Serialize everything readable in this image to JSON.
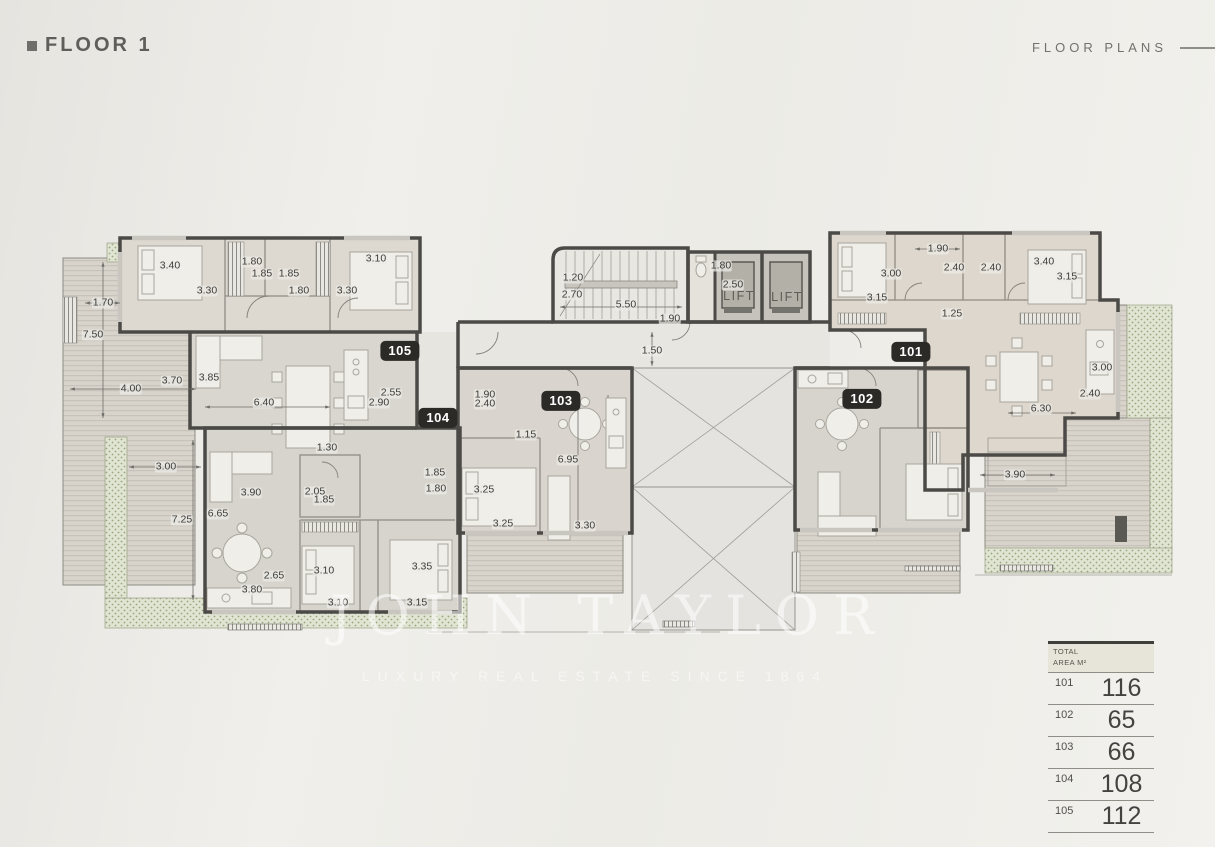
{
  "header": {
    "title": "FLOOR 1",
    "section": "FLOOR PLANS"
  },
  "watermark": {
    "brand": "JOHN TAYLOR",
    "tagline": "LUXURY REAL ESTATE SINCE 1864"
  },
  "plan": {
    "floor_name": "Floor 1",
    "lift_label": "LIFT",
    "lifts": [
      {
        "x": 739,
        "y": 296
      },
      {
        "x": 787,
        "y": 297
      }
    ],
    "badges": [
      {
        "unit": "105",
        "x": 400,
        "y": 351
      },
      {
        "unit": "104",
        "x": 438,
        "y": 418
      },
      {
        "unit": "103",
        "x": 561,
        "y": 401
      },
      {
        "unit": "102",
        "x": 862,
        "y": 399
      },
      {
        "unit": "101",
        "x": 911,
        "y": 352
      }
    ],
    "dimensions": [
      {
        "t": "3.40",
        "x": 170,
        "y": 266
      },
      {
        "t": "1.80",
        "x": 252,
        "y": 262
      },
      {
        "t": "1.85",
        "x": 262,
        "y": 274
      },
      {
        "t": "1.85",
        "x": 289,
        "y": 274
      },
      {
        "t": "3.10",
        "x": 376,
        "y": 259
      },
      {
        "t": "3.30",
        "x": 207,
        "y": 291
      },
      {
        "t": "1.80",
        "x": 299,
        "y": 291
      },
      {
        "t": "3.30",
        "x": 347,
        "y": 291
      },
      {
        "t": "1.70",
        "x": 103,
        "y": 303
      },
      {
        "t": "7.50",
        "x": 93,
        "y": 335
      },
      {
        "t": "3.70",
        "x": 172,
        "y": 381
      },
      {
        "t": "3.85",
        "x": 209,
        "y": 378
      },
      {
        "t": "4.00",
        "x": 131,
        "y": 389
      },
      {
        "t": "6.40",
        "x": 264,
        "y": 403
      },
      {
        "t": "2.55",
        "x": 391,
        "y": 393
      },
      {
        "t": "2.90",
        "x": 379,
        "y": 403
      },
      {
        "t": "1.30",
        "x": 327,
        "y": 448
      },
      {
        "t": "1.20",
        "x": 573,
        "y": 278
      },
      {
        "t": "2.70",
        "x": 572,
        "y": 295
      },
      {
        "t": "5.50",
        "x": 626,
        "y": 305
      },
      {
        "t": "1.90",
        "x": 670,
        "y": 319
      },
      {
        "t": "1.80",
        "x": 721,
        "y": 266
      },
      {
        "t": "2.50",
        "x": 733,
        "y": 285
      },
      {
        "t": "1.50",
        "x": 652,
        "y": 351
      },
      {
        "t": "1.90",
        "x": 485,
        "y": 395
      },
      {
        "t": "2.40",
        "x": 485,
        "y": 404
      },
      {
        "t": "1.15",
        "x": 526,
        "y": 435
      },
      {
        "t": "6.95",
        "x": 568,
        "y": 460
      },
      {
        "t": "3.25",
        "x": 484,
        "y": 490
      },
      {
        "t": "3.25",
        "x": 503,
        "y": 524
      },
      {
        "t": "3.30",
        "x": 585,
        "y": 526
      },
      {
        "t": "3.00",
        "x": 166,
        "y": 467
      },
      {
        "t": "7.25",
        "x": 182,
        "y": 520
      },
      {
        "t": "3.90",
        "x": 251,
        "y": 493
      },
      {
        "t": "2.05",
        "x": 315,
        "y": 492
      },
      {
        "t": "1.85",
        "x": 324,
        "y": 500
      },
      {
        "t": "6.65",
        "x": 218,
        "y": 514
      },
      {
        "t": "1.85",
        "x": 435,
        "y": 473
      },
      {
        "t": "1.80",
        "x": 436,
        "y": 489
      },
      {
        "t": "2.65",
        "x": 274,
        "y": 576
      },
      {
        "t": "3.80",
        "x": 252,
        "y": 590
      },
      {
        "t": "3.10",
        "x": 324,
        "y": 571
      },
      {
        "t": "3.35",
        "x": 422,
        "y": 567
      },
      {
        "t": "3.10",
        "x": 338,
        "y": 603
      },
      {
        "t": "3.15",
        "x": 417,
        "y": 603
      },
      {
        "t": "1.90",
        "x": 938,
        "y": 249
      },
      {
        "t": "3.00",
        "x": 891,
        "y": 274
      },
      {
        "t": "3.15",
        "x": 877,
        "y": 298
      },
      {
        "t": "2.40",
        "x": 954,
        "y": 268
      },
      {
        "t": "2.40",
        "x": 991,
        "y": 268
      },
      {
        "t": "3.40",
        "x": 1044,
        "y": 262
      },
      {
        "t": "3.15",
        "x": 1067,
        "y": 277
      },
      {
        "t": "1.25",
        "x": 952,
        "y": 314
      },
      {
        "t": "3.00",
        "x": 1102,
        "y": 368
      },
      {
        "t": "2.40",
        "x": 1090,
        "y": 394
      },
      {
        "t": "6.30",
        "x": 1041,
        "y": 409
      },
      {
        "t": "3.90",
        "x": 1015,
        "y": 475
      }
    ]
  },
  "table": {
    "header_line1": "TOTAL",
    "header_line2": "AREA M²",
    "rows": [
      {
        "unit": "101",
        "area": "116"
      },
      {
        "unit": "102",
        "area": "65"
      },
      {
        "unit": "103",
        "area": "66"
      },
      {
        "unit": "104",
        "area": "108"
      },
      {
        "unit": "105",
        "area": "112"
      }
    ]
  },
  "colors": {
    "wall": "#4c4a46",
    "badge_bg": "#2b2a27",
    "deck": "#d8d4cc",
    "deck_stripe": "#c7c3ba",
    "planter": "#e0e4d3",
    "planter_dot": "#98a77e"
  }
}
